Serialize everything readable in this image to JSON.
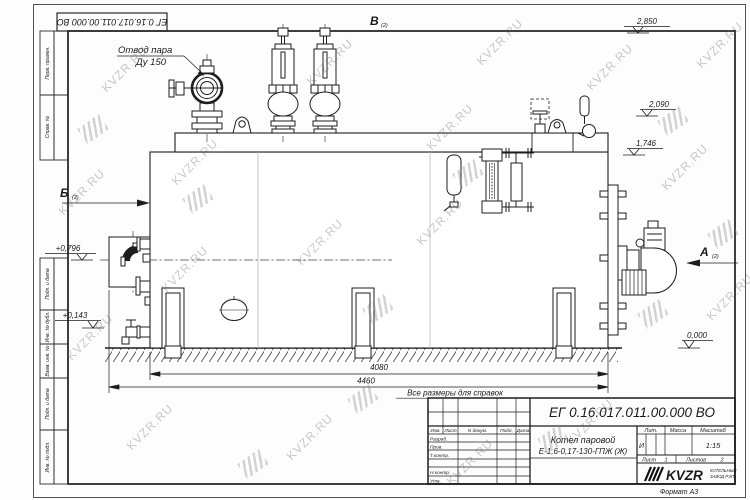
{
  "watermark": {
    "text": "KVZR.RU"
  },
  "drawing": {
    "doc_number": "ЕГ 0.16.017.011.00.000  ВО",
    "note": "Все размеры для справок",
    "callout": {
      "line1": "Отвод пара",
      "line2": "Ду 150"
    },
    "views": {
      "a": "А",
      "b": "Б",
      "v": "В",
      "ref": "(2)"
    },
    "dims": {
      "inner_length": "4080",
      "total_length": "4460"
    },
    "levels": {
      "l1": "2,850",
      "l2": "2,090",
      "l3": "1,746",
      "l4": "+0,796",
      "l5": "+0,143",
      "l6": "0,000"
    }
  },
  "frame": {
    "labels": {
      "f1": "Перв. примен.",
      "f2": "Справ. №",
      "f3": "Подп. и дата",
      "f4": "Инв. № дубл.",
      "f5": "Взам. инв. №",
      "f6": "Подп. и дата",
      "f7": "Инв. № подл."
    },
    "format": "Формат А3"
  },
  "title_block": {
    "doc_number": "ЕГ 0.16.017.011.00.000  ВО",
    "product_name": "Котел паровой",
    "product_code": "Е-1,6-0,17-130-ГПЖ (Ж)",
    "litera_label": "Лит.",
    "mass_label": "Масса",
    "scale_label": "Масштаб",
    "litera": "И",
    "scale": "1:15",
    "sheet_label": "Лист",
    "sheet_no": "1",
    "sheets_label": "Листов",
    "sheets_no": "2",
    "sign_header": {
      "c1": "Изм.",
      "c2": "Лист",
      "c3": "N докум.",
      "c4": "Подп.",
      "c5": "Дата"
    },
    "sign_rows": {
      "r1": "Разраб.",
      "r2": "Пров.",
      "r3": "Т.контр.",
      "r4": "Н.контр.",
      "r5": "Утв."
    },
    "logo": {
      "text": "KVZR",
      "sub1": "КОТЕЛЬНЫЙ",
      "sub2": "ЗАВОД РЭП"
    }
  }
}
